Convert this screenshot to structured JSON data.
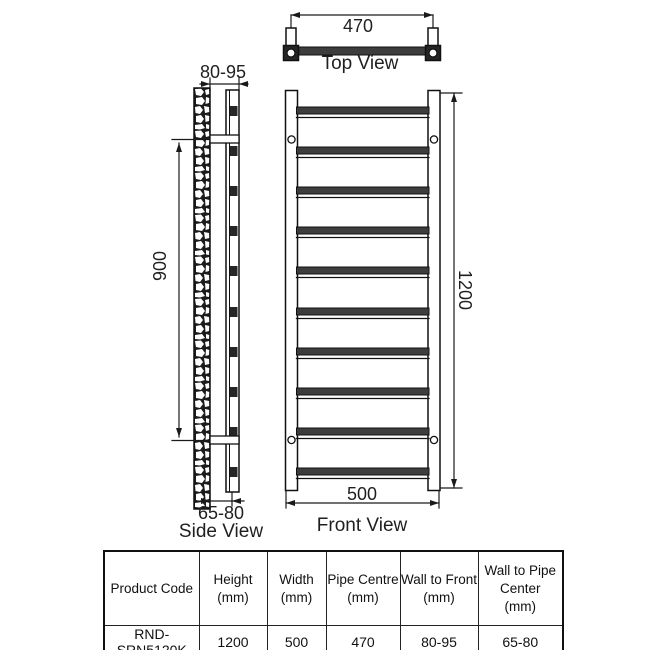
{
  "views": {
    "top": {
      "caption": "Top View",
      "pipe_centre_dim": "470"
    },
    "side": {
      "caption": "Side View",
      "wall_to_front_dim": "80-95",
      "bracket_span_dim": "900",
      "wall_to_pipe_center_dim": "65-80"
    },
    "front": {
      "caption": "Front View",
      "height_dim": "1200",
      "width_dim": "500"
    }
  },
  "table": {
    "headers": [
      "Product Code",
      "Height\n(mm)",
      "Width\n(mm)",
      "Pipe Centre\n(mm)",
      "Wall to Front\n(mm)",
      "Wall to Pipe\nCenter\n(mm)"
    ],
    "row": [
      "RND-SRN5120K",
      "1200",
      "500",
      "470",
      "80-95",
      "65-80"
    ]
  },
  "colors": {
    "line": "#1a1a1a",
    "rung_fill": "#3d3d3d",
    "bracket_fill": "#262626",
    "wall_fill": "#1c1c1c"
  }
}
